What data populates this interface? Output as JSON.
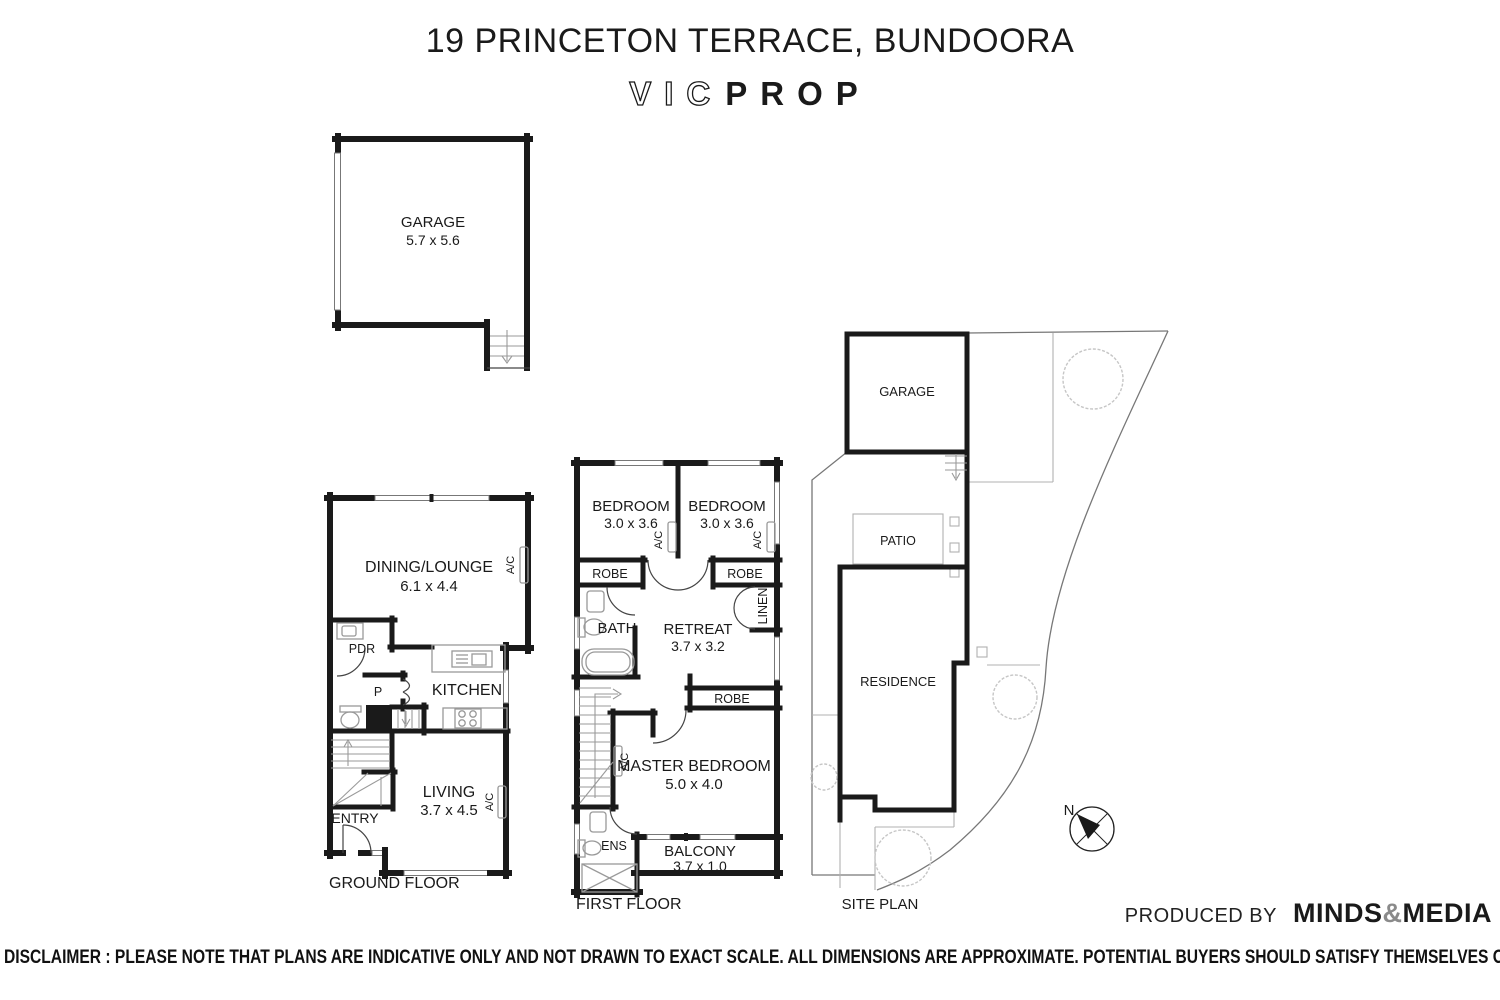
{
  "header": {
    "title": "19 PRINCETON TERRACE, BUNDOORA",
    "logo": {
      "outline": "VIC",
      "solid": "PROP"
    }
  },
  "garage_plan": {
    "room": "GARAGE",
    "dims": "5.7 x 5.6"
  },
  "ground_floor": {
    "label": "GROUND FLOOR",
    "dining": "DINING/LOUNGE",
    "dining_dims": "6.1 x 4.4",
    "kitchen": "KITCHEN",
    "living": "LIVING",
    "living_dims": "3.7 x 4.5",
    "pdr": "PDR",
    "pantry": "P",
    "entry": "ENTRY",
    "ac": "A/C"
  },
  "first_floor": {
    "label": "FIRST FLOOR",
    "bedroom": "BEDROOM",
    "bedroom_dims": "3.0 x 3.6",
    "robe": "ROBE",
    "bath": "BATH",
    "retreat": "RETREAT",
    "retreat_dims": "3.7 x 3.2",
    "linen": "LINEN",
    "master": "MASTER BEDROOM",
    "master_dims": "5.0 x 4.0",
    "ens": "ENS",
    "balcony": "BALCONY",
    "balcony_dims": "3.7 x 1.0",
    "ac": "A/C"
  },
  "site_plan": {
    "label": "SITE PLAN",
    "garage": "GARAGE",
    "patio": "PATIO",
    "residence": "RESIDENCE",
    "compass": "N"
  },
  "footer": {
    "produced_by": "PRODUCED BY",
    "brand_minds": "MINDS",
    "brand_amp": "&",
    "brand_media": "MEDIA",
    "disclaimer": "DISCLAIMER : PLEASE NOTE THAT PLANS ARE INDICATIVE ONLY AND NOT DRAWN TO EXACT SCALE. ALL DIMENSIONS ARE APPROXIMATE. POTENTIAL BUYERS SHOULD SATISFY THEMSELVES OF ANY PERTINENT MATTERS."
  },
  "colors": {
    "ink": "#1a1a1a",
    "fixture": "#999999",
    "boundary": "#aaaaaa",
    "tree": "#c6c6c6"
  }
}
